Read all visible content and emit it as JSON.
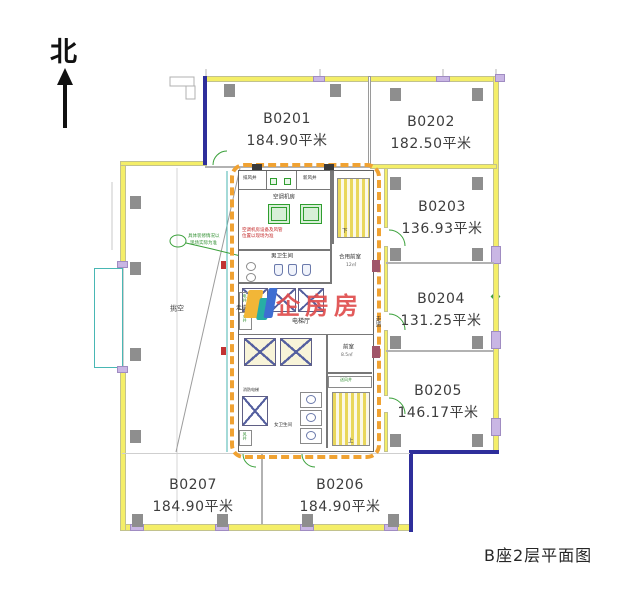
{
  "page": {
    "title": "B座2层平面图",
    "north_label": "北",
    "watermark_text": "企房房"
  },
  "rooms": [
    {
      "id": "B0201",
      "area": "184.90平米"
    },
    {
      "id": "B0202",
      "area": "182.50平米"
    },
    {
      "id": "B0203",
      "area": "136.93平米"
    },
    {
      "id": "B0204",
      "area": "131.25平米"
    },
    {
      "id": "B0205",
      "area": "146.17平米"
    },
    {
      "id": "B0206",
      "area": "184.90平米"
    },
    {
      "id": "B0207",
      "area": "184.90平米"
    }
  ],
  "core": {
    "exhaust_shaft": "排风井",
    "fresh_air_shaft": "新风井",
    "ac_room": "空调机房",
    "mens_toilet": "男卫生间",
    "shared_front_room": "合用前室",
    "shared_front_room_area": "12㎡",
    "elevator_hall": "电梯厅",
    "front_room": "前室",
    "front_room_area": "8.5㎡",
    "supply_shaft": "送风井",
    "womens_toilet": "女卫生间",
    "fire_elevator": "消防电梯",
    "corridor": "走道",
    "void_area": "挑空",
    "stair_down": "下",
    "stair_up": "上",
    "elec_shaft": "电井",
    "water_shaft": "水井",
    "wind_shaft": "风井"
  },
  "annotations": {
    "green_note_line1": "具体装修情况以",
    "green_note_line2": "现场实际为准",
    "red_note_line1": "空调机房设备及风管",
    "red_note_line2": "位置以现场为准"
  },
  "colors": {
    "wall_yellow": "#f4ee68",
    "core_dash_orange": "#f0a232",
    "navy_wall": "#2e2e9b",
    "green_marks": "#3aa03a",
    "watermark_red": "#e04d4d",
    "column_gray": "#8e8e8e",
    "balcony_teal": "#49b7b4"
  }
}
